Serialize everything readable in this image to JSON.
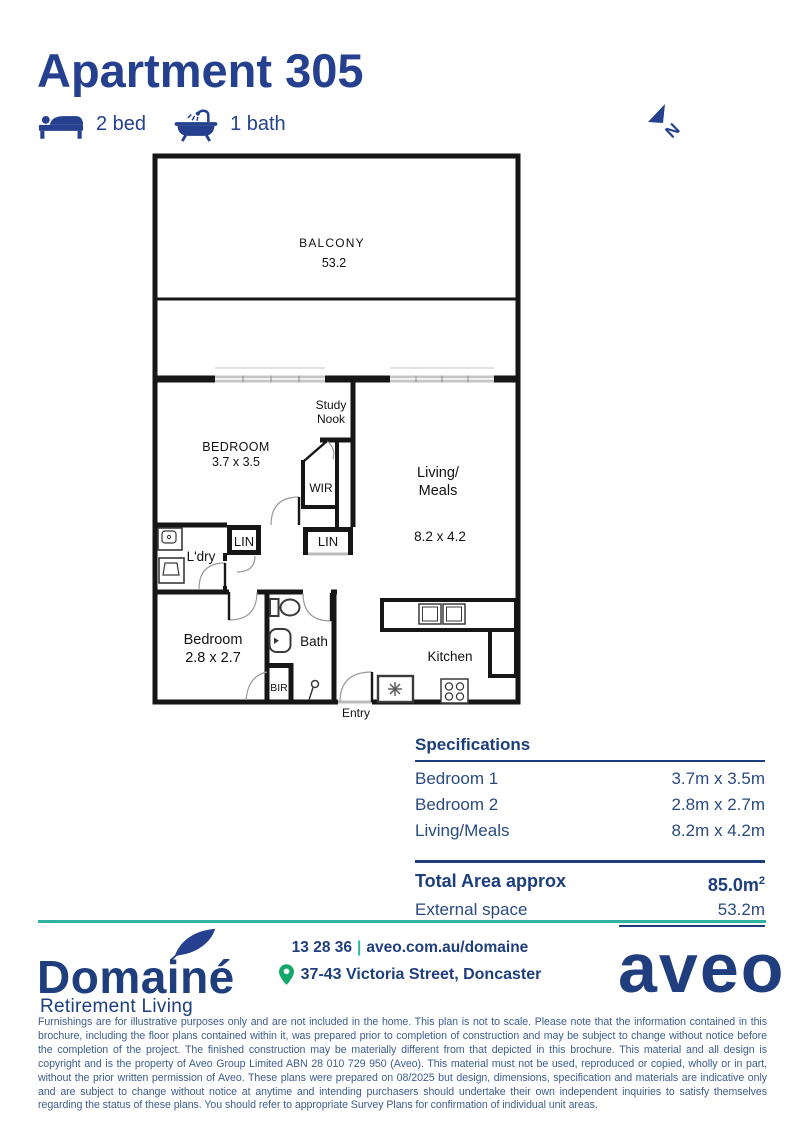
{
  "colors": {
    "navy": "#24408E",
    "spec_blue": "#1C3E7D",
    "teal": "#2FB3A0",
    "pin_green": "#13A96B",
    "disclaimer_blue": "#3F5C8E",
    "plan_black": "#161616"
  },
  "header": {
    "title": "Apartment 305",
    "bed_label": "2 bed",
    "bath_label": "1 bath"
  },
  "north": {
    "label": "N"
  },
  "floorplan": {
    "balcony_label": "BALCONY",
    "balcony_area": "53.2",
    "bedroom1_label": "BEDROOM",
    "bedroom1_dims": "3.7 x 3.5",
    "study_nook_line1": "Study",
    "study_nook_line2": "Nook",
    "wir_label": "WIR",
    "lin1_label": "LIN",
    "lin2_label": "LIN",
    "ldry_label": "L'dry",
    "living_line1": "Living/",
    "living_line2": "Meals",
    "living_dims": "8.2 x 4.2",
    "bedroom2_label": "Bedroom",
    "bedroom2_dims": "2.8 x 2.7",
    "bath_label": "Bath",
    "bir_label": "BIR",
    "kitchen_label": "Kitchen",
    "entry_label": "Entry"
  },
  "specs": {
    "heading": "Specifications",
    "rows": [
      {
        "label": "Bedroom 1",
        "value": "3.7m x 3.5m"
      },
      {
        "label": "Bedroom 2",
        "value": "2.8m x 2.7m"
      },
      {
        "label": "Living/Meals",
        "value": "8.2m x 4.2m"
      }
    ],
    "total_label": "Total Area approx",
    "total_value": "85.0m",
    "total_value_sup": "2",
    "external_label": "External space",
    "external_value": "53.2m"
  },
  "footer": {
    "brand": "Domainé",
    "brand_sub": "Retirement Living",
    "phone": "13 28 36",
    "separator": "|",
    "website": "aveo.com.au/domaine",
    "address": "37-43 Victoria Street, Doncaster",
    "aveo_logo_text": "aveo"
  },
  "disclaimer": "Furnishings are for illustrative purposes only and are not included in the home. This plan is not to scale. Please note that the information contained in this brochure, including the floor plans contained within it, was prepared prior to completion of construction and may be subject to change without notice before the completion of the project. The finished construction may be materially different from that depicted in this brochure. This material and all design is copyright and is the property of Aveo Group Limited ABN 28 010 729 950 (Aveo). This material must not be used, reproduced or copied, wholly or in part, without the prior written permission of Aveo. These plans were prepared on 08/2025 but design, dimensions, specification and materials are indicative only and are subject to change without notice at anytime and intending purchasers should undertake their own independent inquiries to satisfy themselves regarding the status of these plans. You should refer to appropriate Survey Plans for confirmation of individual unit areas."
}
